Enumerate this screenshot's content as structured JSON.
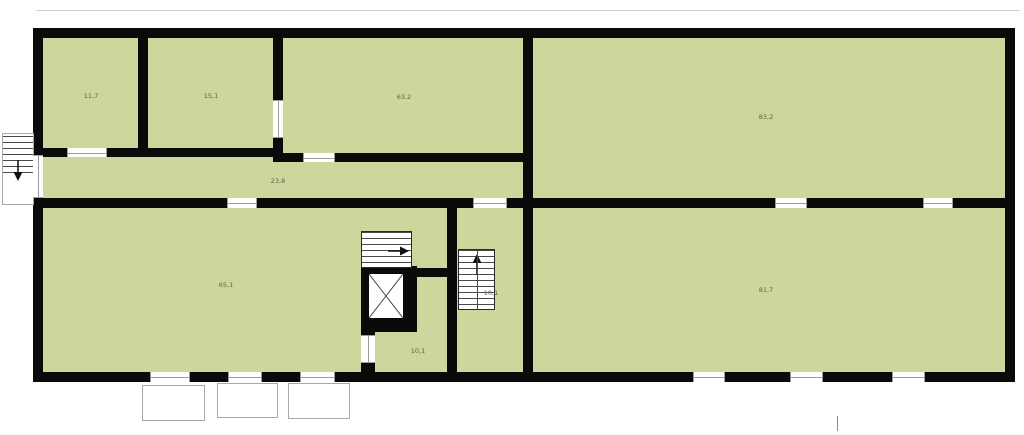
{
  "floorplan": {
    "rooms": [
      {
        "name": "top-room-1",
        "area": "11,7"
      },
      {
        "name": "top-room-2",
        "area": "15,1"
      },
      {
        "name": "top-room-3",
        "area": "63,2"
      },
      {
        "name": "top-right-hall",
        "area": "83,2"
      },
      {
        "name": "corridor",
        "area": "23,8"
      },
      {
        "name": "bottom-left-hall",
        "area": "65,1"
      },
      {
        "name": "stairwell",
        "area": "10,1"
      },
      {
        "name": "bottom-middle-room",
        "area": "10,1"
      },
      {
        "name": "bottom-right-hall",
        "area": "81,7"
      }
    ],
    "icons": [
      {
        "name": "stair-direction-right-arrow-icon",
        "glyph": "→"
      },
      {
        "name": "stair-direction-up-arrow-icon",
        "glyph": "↑"
      },
      {
        "name": "stair-direction-down-arrow-icon",
        "glyph": "↓"
      }
    ],
    "colors": {
      "room_fill": "#ccd79e",
      "wall": "#0a0a0a",
      "opening_line": "#9b9b9b",
      "exterior_outline": "#a8a8a8",
      "label": "#5b6247",
      "background": "#ffffff"
    }
  }
}
